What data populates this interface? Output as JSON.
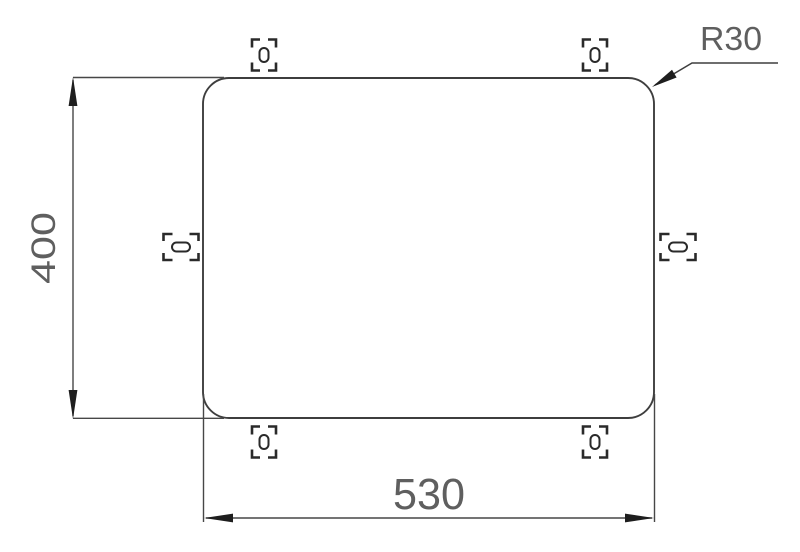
{
  "drawing": {
    "labels": {
      "height": "400",
      "width": "530",
      "corner_radius": "R30"
    },
    "panel": {
      "width_value": 530,
      "height_value": 400,
      "corner_radius_value": 30
    },
    "fasteners": {
      "icon": "clip-slot-icon",
      "count": 6,
      "positions": [
        "top-left",
        "top-right",
        "left",
        "right",
        "bottom-left",
        "bottom-right"
      ]
    },
    "colors": {
      "background": "#ffffff",
      "line": "#3e3e3e",
      "dimension_line": "#474747",
      "arrow": "#1e1e1e",
      "clip": "#2a2a2a",
      "text": "#5f5f5f"
    }
  }
}
